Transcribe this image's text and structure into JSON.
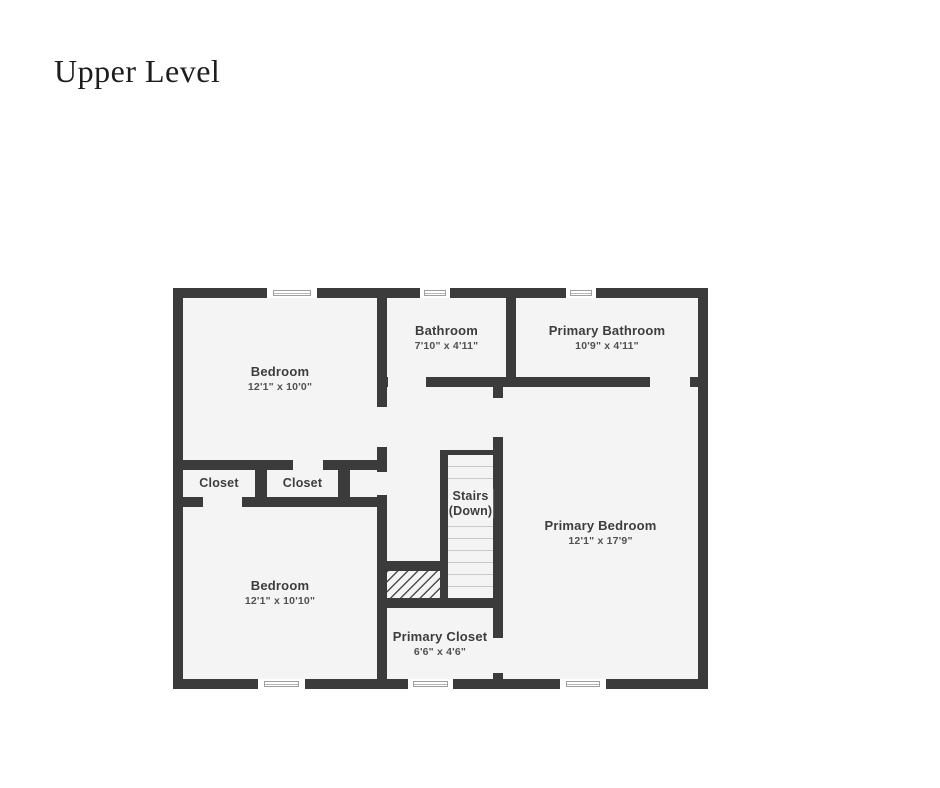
{
  "page": {
    "title": "Upper Level"
  },
  "palette": {
    "wall": "#3b3b3b",
    "room_fill": "#f4f4f4",
    "page_background": "#ffffff",
    "room_name_color": "#3d3d3d",
    "room_dims_color": "#515151",
    "stair_tread_line": "#c9c9c9"
  },
  "rooms": {
    "bedroom_top": {
      "name": "Bedroom",
      "dims": "12'1\" x 10'0\""
    },
    "bathroom": {
      "name": "Bathroom",
      "dims": "7'10\" x 4'11\""
    },
    "primary_bathroom": {
      "name": "Primary Bathroom",
      "dims": "10'9\" x 4'11\""
    },
    "closet_1": {
      "name": "Closet"
    },
    "closet_2": {
      "name": "Closet"
    },
    "stairs": {
      "name": "Stairs",
      "direction": "(Down)"
    },
    "primary_bedroom": {
      "name": "Primary Bedroom",
      "dims": "12'1\" x 17'9\""
    },
    "bedroom_bottom": {
      "name": "Bedroom",
      "dims": "12'1\" x 10'10\""
    },
    "primary_closet": {
      "name": "Primary Closet",
      "dims": "6'6\" x 4'6\""
    }
  }
}
